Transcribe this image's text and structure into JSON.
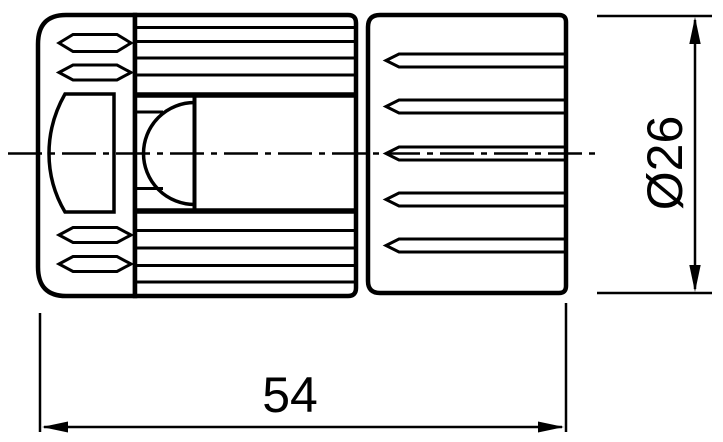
{
  "drawing": {
    "background_color": "#ffffff",
    "line_color": "#000000",
    "dimensions": {
      "length_label": "54",
      "diameter_label": "Ø26"
    }
  }
}
